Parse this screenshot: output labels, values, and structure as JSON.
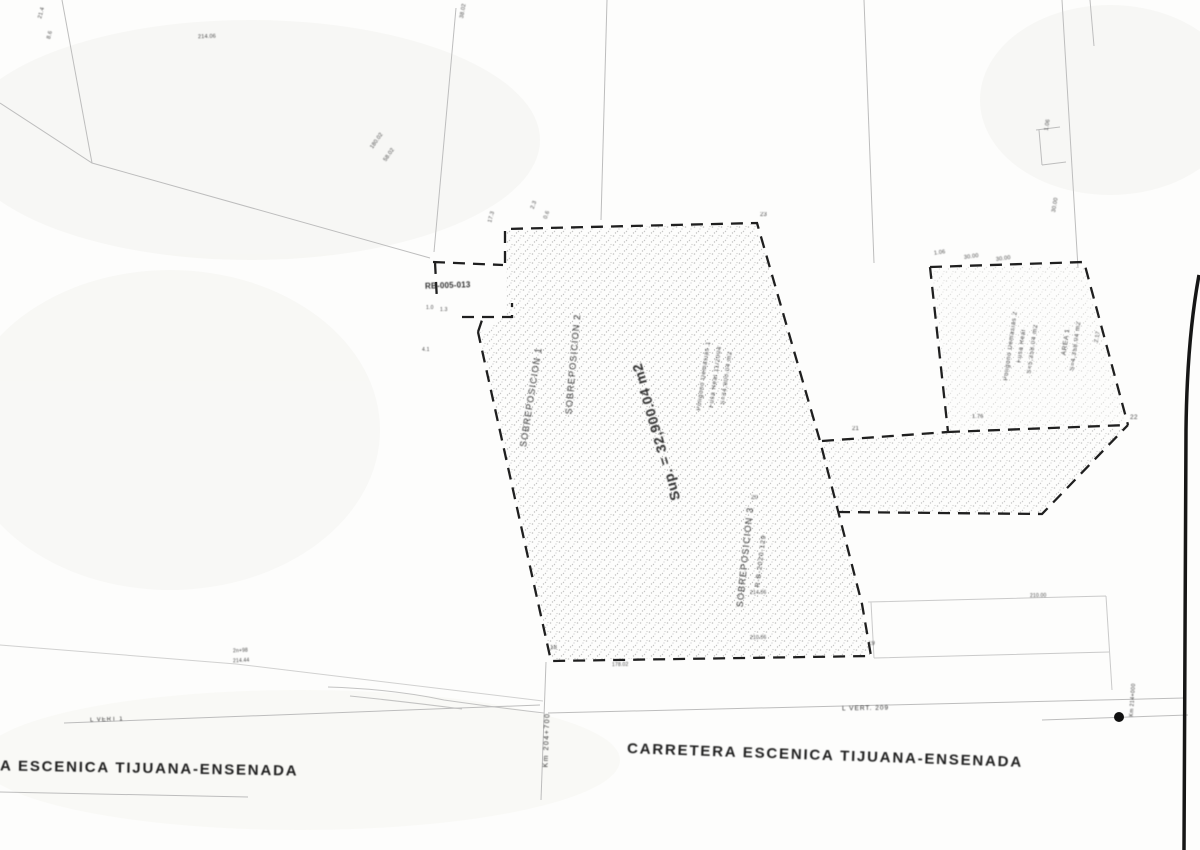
{
  "colors": {
    "ink": "#262626",
    "faint_line": "#bdbdbd",
    "paper": "#fdfdfc",
    "station_dot": "#111111"
  },
  "parcel": {
    "sup_label": "Sup. = 32,900.04 m2",
    "sobreposicion_1": "SOBREPOSICION 1",
    "sobreposicion_2": "SOBREPOSICION 2",
    "sobreposicion_3": "SOBREPOSICION 3",
    "sobreposicion_3_ref": "R-B-2020-129",
    "rb_label": "RB-005-013",
    "block_a": [
      "Poligono Demasias 1",
      "Fusa Real 11/2004",
      "S=34,900.04 m2"
    ],
    "block_b": [
      "Poligono Demasias 2",
      "Fusa Real",
      "S=5,358.04 m2"
    ],
    "block_c": [
      "AREA 1",
      "S=4,358.04 m2"
    ]
  },
  "road": {
    "left_label": "A ESCENICA TIJUANA-ENSENADA",
    "center_label": "CARRETERA ESCENICA TIJUANA-ENSENADA",
    "km_left": "Km 204+700",
    "km_right": "Km 214+000",
    "vert_left": "L VERT 1",
    "vert_right": "L VERT. 209"
  },
  "micro_labels": [
    "21.4",
    "8.6",
    "214.06",
    "38.02",
    "180.02",
    "58.02",
    "17.3",
    "2.3",
    "0.6",
    "23",
    "1.06",
    "30.00",
    "30.00",
    "1.06",
    "30.00",
    "2.17",
    "22",
    "1.76",
    "21",
    "20",
    "19",
    "18",
    "178.02",
    "214.06",
    "210.00",
    "210.06",
    "2n+98",
    "214.44",
    "1.0",
    "1.3",
    "4.1"
  ]
}
